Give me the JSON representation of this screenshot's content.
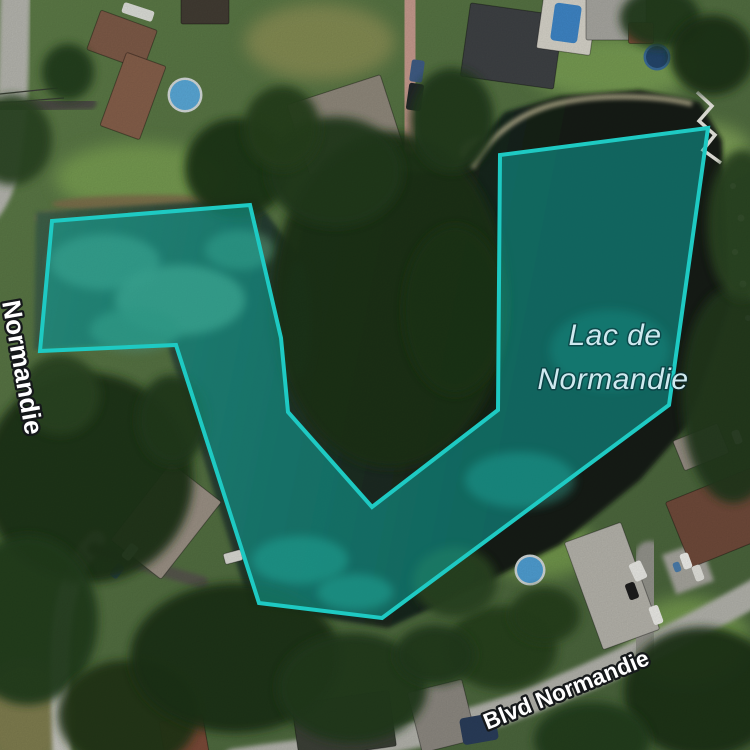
{
  "labels": {
    "lake": {
      "line1": "Lac de",
      "line2": "Normandie",
      "x1": 615,
      "y1": 345,
      "x2": 613,
      "y2": 389,
      "font_size": 30,
      "letter_spacing": 0.5,
      "color": "#cfe9ef",
      "halo": "rgba(8,40,50,0.55)",
      "halo_width": 3
    },
    "street_bottom": {
      "text": "Blvd Normandie",
      "x": 569,
      "y": 697,
      "angle": -22,
      "font_size": 23,
      "color": "#ffffff",
      "halo": "#15181a",
      "halo_width": 4.5
    },
    "street_left": {
      "text": "Normandie",
      "x": 2,
      "y": 302,
      "angle": 80,
      "font_size": 26,
      "color": "#ffffff",
      "halo": "#15181a",
      "halo_width": 4.5
    }
  },
  "selection": {
    "points": [
      [
        52,
        221
      ],
      [
        250,
        205
      ],
      [
        281,
        338
      ],
      [
        288,
        412
      ],
      [
        372,
        507
      ],
      [
        498,
        410
      ],
      [
        500,
        155
      ],
      [
        708,
        128
      ],
      [
        669,
        405
      ],
      [
        382,
        618
      ],
      [
        259,
        603
      ],
      [
        176,
        345
      ],
      [
        40,
        351
      ]
    ],
    "stroke": "#1ecac3",
    "stroke_width": 4,
    "fill": "rgba(14,176,168,0.5)"
  },
  "scene": {
    "viewport": {
      "w": 750,
      "h": 750
    },
    "base_gradient": {
      "from": "#5d7b47",
      "to": "#47613a"
    },
    "water_gradient": {
      "left": "#41634a",
      "right": "#131c13"
    },
    "water_polygon": [
      [
        36,
        212
      ],
      [
        255,
        198
      ],
      [
        298,
        255
      ],
      [
        306,
        205
      ],
      [
        352,
        172
      ],
      [
        452,
        172
      ],
      [
        470,
        150
      ],
      [
        505,
        112
      ],
      [
        560,
        96
      ],
      [
        640,
        90
      ],
      [
        700,
        102
      ],
      [
        722,
        140
      ],
      [
        730,
        305
      ],
      [
        688,
        425
      ],
      [
        640,
        480
      ],
      [
        560,
        545
      ],
      [
        470,
        590
      ],
      [
        388,
        628
      ],
      [
        250,
        606
      ],
      [
        166,
        340
      ],
      [
        34,
        350
      ]
    ],
    "water_light_patches": [
      [
        105,
        262,
        55,
        28,
        "#5f8f72"
      ],
      [
        180,
        300,
        65,
        35,
        "#679878"
      ],
      [
        135,
        330,
        45,
        22,
        "#558767"
      ],
      [
        240,
        250,
        35,
        20,
        "#4e7f63"
      ],
      [
        300,
        560,
        48,
        24,
        "#2f7a68"
      ],
      [
        355,
        592,
        38,
        18,
        "#2f7a68"
      ],
      [
        520,
        480,
        55,
        28,
        "#27675c"
      ],
      [
        610,
        350,
        60,
        40,
        "#1d4a40"
      ],
      [
        298,
        320,
        14,
        60,
        "#2f6f5f"
      ]
    ],
    "grass_patches": [
      [
        140,
        178,
        85,
        35,
        "#7da353"
      ],
      [
        320,
        42,
        75,
        38,
        "#8e9156"
      ],
      [
        612,
        68,
        85,
        32,
        "#7fa557"
      ],
      [
        700,
        148,
        50,
        25,
        "#86a95c"
      ],
      [
        540,
        548,
        55,
        30,
        "#79a050"
      ],
      [
        688,
        642,
        62,
        45,
        "#7da353"
      ],
      [
        25,
        718,
        45,
        55,
        "#8b8153"
      ]
    ],
    "shore_patches": [
      [
        152,
        204,
        100,
        9,
        "#7d6d4b"
      ],
      [
        57,
        218,
        22,
        7,
        "#8a7a55"
      ],
      [
        482,
        152,
        22,
        15,
        "#cdc29b"
      ]
    ],
    "shore_path": {
      "d": "M 472,168 C 490,135 520,112 560,103 C 600,94 655,95 692,104",
      "w": 5,
      "c": "#bfb794"
    },
    "roads": [
      {
        "d": "M 16,-12 C 13,45 16,95 6,158 C 2,185 -8,205 -20,215",
        "w": 30,
        "c": "#b5b5ae"
      },
      {
        "d": "M 96,540 C 64,572 58,630 60,690 C 61,720 62,745 62,765",
        "w": 19,
        "c": "#c6c6bf"
      },
      {
        "d": "M 235,762 C 330,748 430,740 525,703 C 615,668 685,632 762,589",
        "w": 27,
        "c": "#b2b2ab"
      },
      {
        "d": "M -4,108 C 30,106 60,104 90,103",
        "w": 13,
        "c": "#4c4b44"
      },
      {
        "d": "M 94,549 C 130,560 165,572 202,582",
        "w": 12,
        "c": "#55544c"
      },
      {
        "d": "M 408,-8 C 404,40 416,80 412,135",
        "w": 36,
        "c": "#c59a8d"
      },
      {
        "d": "M 640,648 C 642,615 645,585 650,556",
        "w": 30,
        "c": "#93938b"
      }
    ],
    "pads": [
      [
        688,
        568,
        40,
        42,
        -20,
        "#a5a49c"
      ]
    ],
    "houses": [
      [
        122,
        40,
        60,
        42,
        20,
        "#7d5a47"
      ],
      [
        133,
        96,
        42,
        78,
        20,
        "#855f4a"
      ],
      [
        205,
        11,
        48,
        26,
        0,
        "#423c33"
      ],
      [
        345,
        125,
        98,
        74,
        -18,
        "#8f887b"
      ],
      [
        512,
        46,
        94,
        74,
        8,
        "#3e4144"
      ],
      [
        567,
        24,
        54,
        56,
        8,
        "#d6d3c9"
      ],
      [
        616,
        19,
        60,
        42,
        0,
        "#a7a6a0"
      ],
      [
        641,
        33,
        25,
        21,
        0,
        "#8a4f3d"
      ],
      [
        166,
        521,
        64,
        98,
        38,
        "#9a9084"
      ],
      [
        612,
        586,
        60,
        114,
        -20,
        "#b5b3ab"
      ],
      [
        723,
        517,
        96,
        70,
        -22,
        "#6f4a3a"
      ],
      [
        344,
        725,
        98,
        56,
        -8,
        "#3c4037"
      ],
      [
        442,
        716,
        56,
        62,
        -14,
        "#8c8880"
      ],
      [
        701,
        447,
        48,
        32,
        -22,
        "#978f85"
      ],
      [
        184,
        737,
        44,
        38,
        -10,
        "#7a4a38"
      ],
      [
        233,
        557,
        18,
        11,
        -15,
        "#d9d9d3"
      ]
    ],
    "pool_rects": [
      [
        566,
        23,
        27,
        38,
        8,
        "#3e85c6"
      ],
      [
        479,
        729,
        36,
        27,
        -10,
        "#2a3d5a"
      ]
    ],
    "pool_circles": [
      [
        185,
        95,
        15,
        "#59a8d7",
        "#d3d9d8"
      ],
      [
        530,
        570,
        13,
        "#4f9ed2",
        "#cfd6d6"
      ],
      [
        657,
        57,
        11,
        "#24466b",
        "#3a6b96"
      ]
    ],
    "cars": [
      [
        415,
        97,
        15,
        27,
        8,
        "#23262b"
      ],
      [
        417,
        71,
        13,
        22,
        8,
        "#3f5c84"
      ],
      [
        138,
        12,
        32,
        11,
        18,
        "#dcded8"
      ],
      [
        130,
        552,
        10,
        17,
        38,
        "#e4e4df"
      ],
      [
        117,
        571,
        9,
        15,
        38,
        "#31517a"
      ],
      [
        638,
        571,
        13,
        19,
        -25,
        "#e9e9e4"
      ],
      [
        632,
        591,
        10,
        17,
        -20,
        "#1d1d1d"
      ],
      [
        656,
        615,
        10,
        19,
        -20,
        "#ebebe6"
      ],
      [
        686,
        561,
        9,
        16,
        -20,
        "#eeeeea"
      ],
      [
        698,
        573,
        9,
        16,
        -20,
        "#e2e2dc"
      ],
      [
        677,
        567,
        7,
        10,
        -20,
        "#4a7cab"
      ],
      [
        737,
        437,
        8,
        14,
        -20,
        "#e8e8e2"
      ]
    ],
    "tree_blobs": [
      [
        12,
        140,
        40,
        45,
        "#2a4522"
      ],
      [
        68,
        72,
        26,
        28,
        "#243c1c"
      ],
      [
        237,
        168,
        52,
        50,
        "#1f3418"
      ],
      [
        390,
        300,
        118,
        168,
        "#1d3117"
      ],
      [
        335,
        172,
        68,
        55,
        "#223a1a"
      ],
      [
        455,
        310,
        52,
        85,
        "#1f3518"
      ],
      [
        282,
        128,
        38,
        42,
        "#27411f"
      ],
      [
        452,
        120,
        42,
        52,
        "#223a1b"
      ],
      [
        733,
        395,
        52,
        108,
        "#22391b"
      ],
      [
        742,
        225,
        35,
        75,
        "#2a4521"
      ],
      [
        88,
        478,
        105,
        105,
        "#1e3318"
      ],
      [
        28,
        620,
        70,
        85,
        "#243c1d"
      ],
      [
        128,
        715,
        70,
        55,
        "#203518"
      ],
      [
        235,
        658,
        105,
        75,
        "#1e3318"
      ],
      [
        352,
        688,
        75,
        55,
        "#223a1b"
      ],
      [
        502,
        648,
        55,
        42,
        "#27411f"
      ],
      [
        455,
        582,
        42,
        35,
        "#2a4521"
      ],
      [
        702,
        692,
        78,
        65,
        "#1e3318"
      ],
      [
        592,
        740,
        58,
        38,
        "#243c1d"
      ],
      [
        660,
        18,
        40,
        30,
        "#223a1b"
      ],
      [
        712,
        55,
        42,
        40,
        "#1d3117"
      ],
      [
        172,
        420,
        35,
        45,
        "#223a1b"
      ],
      [
        60,
        395,
        40,
        40,
        "#2a4522"
      ],
      [
        435,
        655,
        40,
        30,
        "#223a1b"
      ],
      [
        545,
        615,
        35,
        28,
        "#27411f"
      ]
    ],
    "dock_polyline": [
      [
        697,
        92
      ],
      [
        712,
        106
      ],
      [
        699,
        121
      ],
      [
        715,
        135
      ],
      [
        703,
        150
      ],
      [
        721,
        163
      ]
    ],
    "dock_color": "#e9e9e1",
    "shore_rocks": [
      [
        733,
        186,
        3
      ],
      [
        741,
        218,
        3.5
      ],
      [
        735,
        252,
        3
      ],
      [
        743,
        284,
        3.5
      ],
      [
        748,
        318,
        3
      ]
    ],
    "rock_color": "#dfe0d6",
    "power_lines": {
      "d": "M 0,94 L 58,88 M 0,103 L 64,98",
      "w": 1.2,
      "c": "#3c3c38"
    }
  }
}
